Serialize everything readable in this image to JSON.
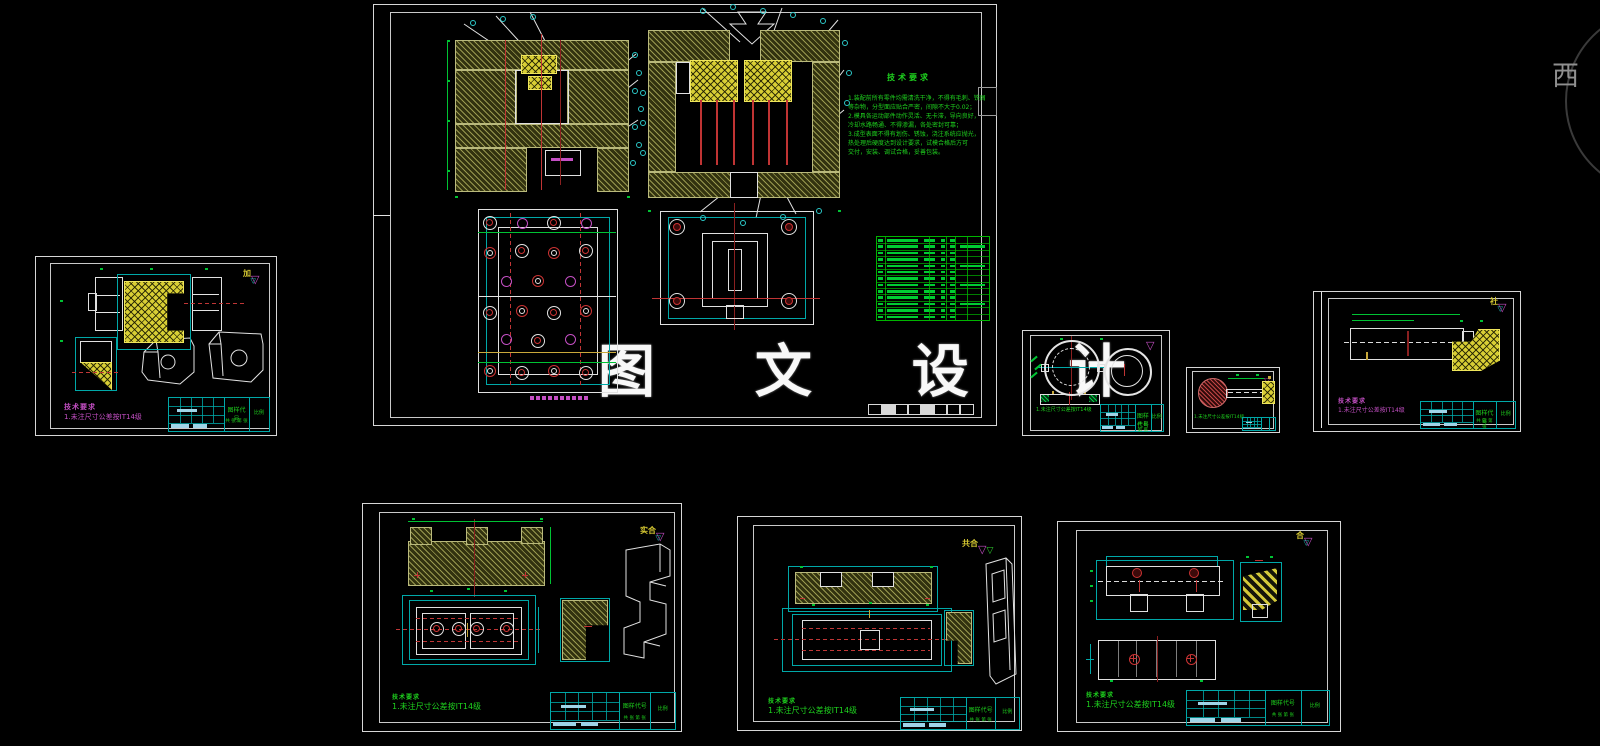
{
  "app": {
    "type": "cad-model-space",
    "background": "#000000"
  },
  "watermark": {
    "text": "图 文 设 计",
    "color": "#f8f8f8"
  },
  "corner_logo": {
    "text": "西",
    "text_color": "#8f8f8f",
    "ring_color": "#3a3a3a"
  },
  "palette": {
    "hatch_olive": "#99994f",
    "hatch_yellow": "#d8ce35",
    "dim_green": "#00c233",
    "line_red": "#c03434",
    "line_cyan": "#00a8a8",
    "line_white": "#e4e4e4",
    "note_magenta": "#c44fc4",
    "titleblock_fill": "#9fd4e8"
  },
  "titleblock": {
    "field_main": "图样代号",
    "field_scale": "比例",
    "field_extra": "共 张 第 张"
  },
  "sheets": {
    "assembly": {
      "label": "模具总装图",
      "tech_req": {
        "title": "技术要求",
        "lines": [
          "1.装配前所有零件均需清洗干净，不得有毛刺、铁屑",
          "等杂物，分型面应贴合严密，间隙不大于0.02；",
          "2.模具各运动部件动作灵活、无卡滞，导向良好，",
          "冷却水路畅通、不得渗漏，各处密封可靠；",
          "3.成型表面不得有划伤、锈蚀，浇注系统应抛光，",
          "热处理后硬度达到设计要求，试模合格后方可",
          "交付，安装、调试合格，妥善包装。"
        ]
      },
      "bom": {
        "rows": 13,
        "cols": 6
      }
    },
    "part_core": {
      "stamp": "加",
      "notes": [
        "技术要求",
        "1.未注尺寸公差按IT14级"
      ]
    },
    "part_rings": {
      "stamp": "",
      "notes": [
        "1.未注尺寸公差按IT14级"
      ]
    },
    "part_pin": {
      "stamp": "",
      "notes": [
        "1.未注尺寸公差按IT14级"
      ]
    },
    "part_plate": {
      "stamp": "社",
      "notes": [
        "技术要求",
        "1.未注尺寸公差按IT14级"
      ]
    },
    "part_holder": {
      "stamp": "实合",
      "notes": [
        "技术要求",
        "1.未注尺寸公差按IT14级"
      ]
    },
    "part_base": {
      "stamp": "共合",
      "notes": [
        "技术要求",
        "1.未注尺寸公差按IT14级"
      ]
    },
    "part_slide": {
      "stamp": "合",
      "notes": [
        "技术要求",
        "1.未注尺寸公差按IT14级"
      ]
    }
  }
}
